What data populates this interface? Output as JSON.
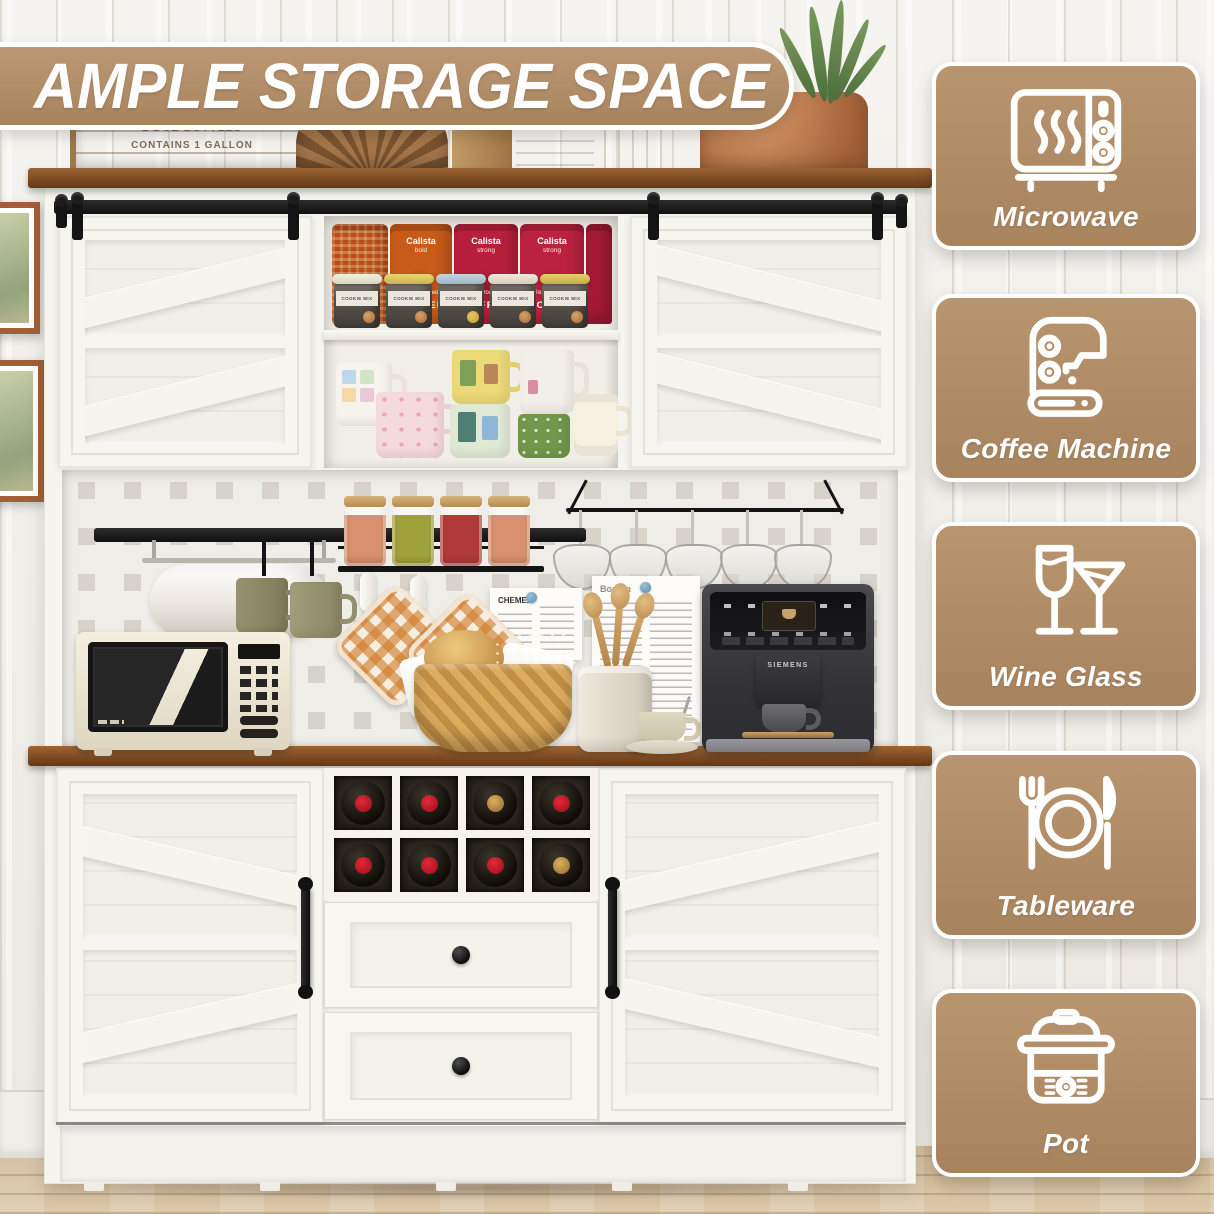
{
  "banner": {
    "title": "AMPLE STORAGE SPACE"
  },
  "theme": {
    "accent_tan": "#b3906d",
    "wood_brown": "#7d4c24",
    "hardware_black": "#161616",
    "cabinet_white": "#f6f4ef"
  },
  "feature_cards": [
    {
      "id": "microwave",
      "label": "Microwave"
    },
    {
      "id": "coffee-machine",
      "label": "Coffee Machine"
    },
    {
      "id": "wine-glass",
      "label": "Wine Glass"
    },
    {
      "id": "tableware",
      "label": "Tableware"
    },
    {
      "id": "pot",
      "label": "Pot"
    }
  ],
  "photo": {
    "crate_stamp": {
      "line1": "2 DOZ BOTTLES",
      "line2": "CONTAINS 1 GALLON"
    },
    "coffee_shelf": {
      "bags": [
        {
          "brand": "Calista",
          "variant": "bold",
          "script": "fresh roasted",
          "word": "COFFEE"
        },
        {
          "brand": "Calista",
          "variant": "strong",
          "script": "fresh roasted",
          "word": "COFFEE"
        },
        {
          "brand": "Calista",
          "variant": "strong",
          "script": "fresh roasted",
          "word": "COFFEE"
        }
      ],
      "canister_label": "COOKIE MIX"
    },
    "coffee_machine_brand": "SIEMENS",
    "papers": {
      "small": "CHEMEX",
      "large": "Bodum"
    }
  }
}
